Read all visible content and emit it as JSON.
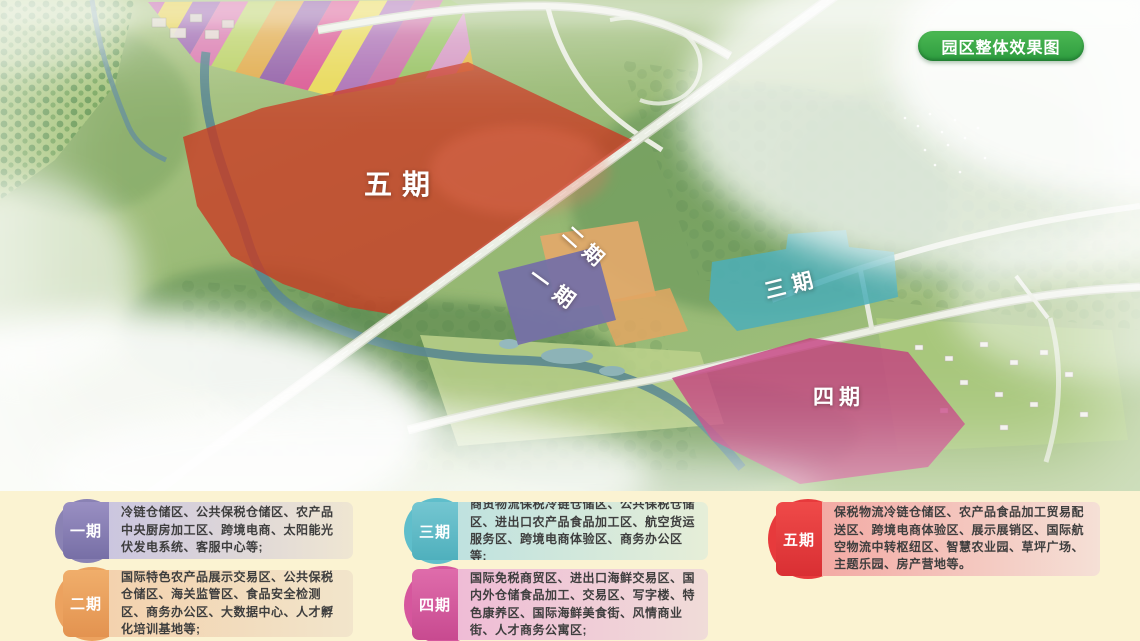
{
  "map": {
    "title_badge": "园区整体效果图",
    "regions": [
      {
        "id": "phase-5",
        "label": "五期",
        "color": "#c62a12"
      },
      {
        "id": "phase-2",
        "label": "二期",
        "color": "#e2a35f"
      },
      {
        "id": "phase-1",
        "label": "一期",
        "color": "#6b66a0"
      },
      {
        "id": "phase-3",
        "label": "三期",
        "color": "#45abb6"
      },
      {
        "id": "phase-4",
        "label": "四期",
        "color": "#c23277"
      }
    ]
  },
  "legend": {
    "items": [
      {
        "label": "一期",
        "color": "#8a82b4",
        "desc": "冷链仓储区、公共保税仓储区、农产品中央厨房加工区、跨境电商、太阳能光伏发电系统、客服中心等;"
      },
      {
        "label": "二期",
        "color": "#eca25f",
        "desc": "国际特色农产品展示交易区、公共保税仓储区、海关监管区、食品安全检测区、商务办公区、大数据中心、人才孵化培训基地等;"
      },
      {
        "label": "三期",
        "color": "#5fbecb",
        "desc": "商贸物流保税冷链仓储区、公共保税仓储区、进出口农产品食品加工区、航空货运服务区、跨境电商体验区、商务办公区等;"
      },
      {
        "label": "四期",
        "color": "#d6569d",
        "desc": "国际免税商贸区、进出口海鲜交易区、国内外仓储食品加工、交易区、写字楼、特色康养区、国际海鲜美食街、风情商业街、人才商务公寓区;"
      },
      {
        "label": "五期",
        "color": "#e73a3c",
        "desc": "保税物流冷链仓储区、农产品食品加工贸易配送区、跨境电商体验区、展示展销区、国际航空物流中转枢纽区、智慧农业园、草坪广场、主题乐园、房产营地等。"
      }
    ]
  }
}
